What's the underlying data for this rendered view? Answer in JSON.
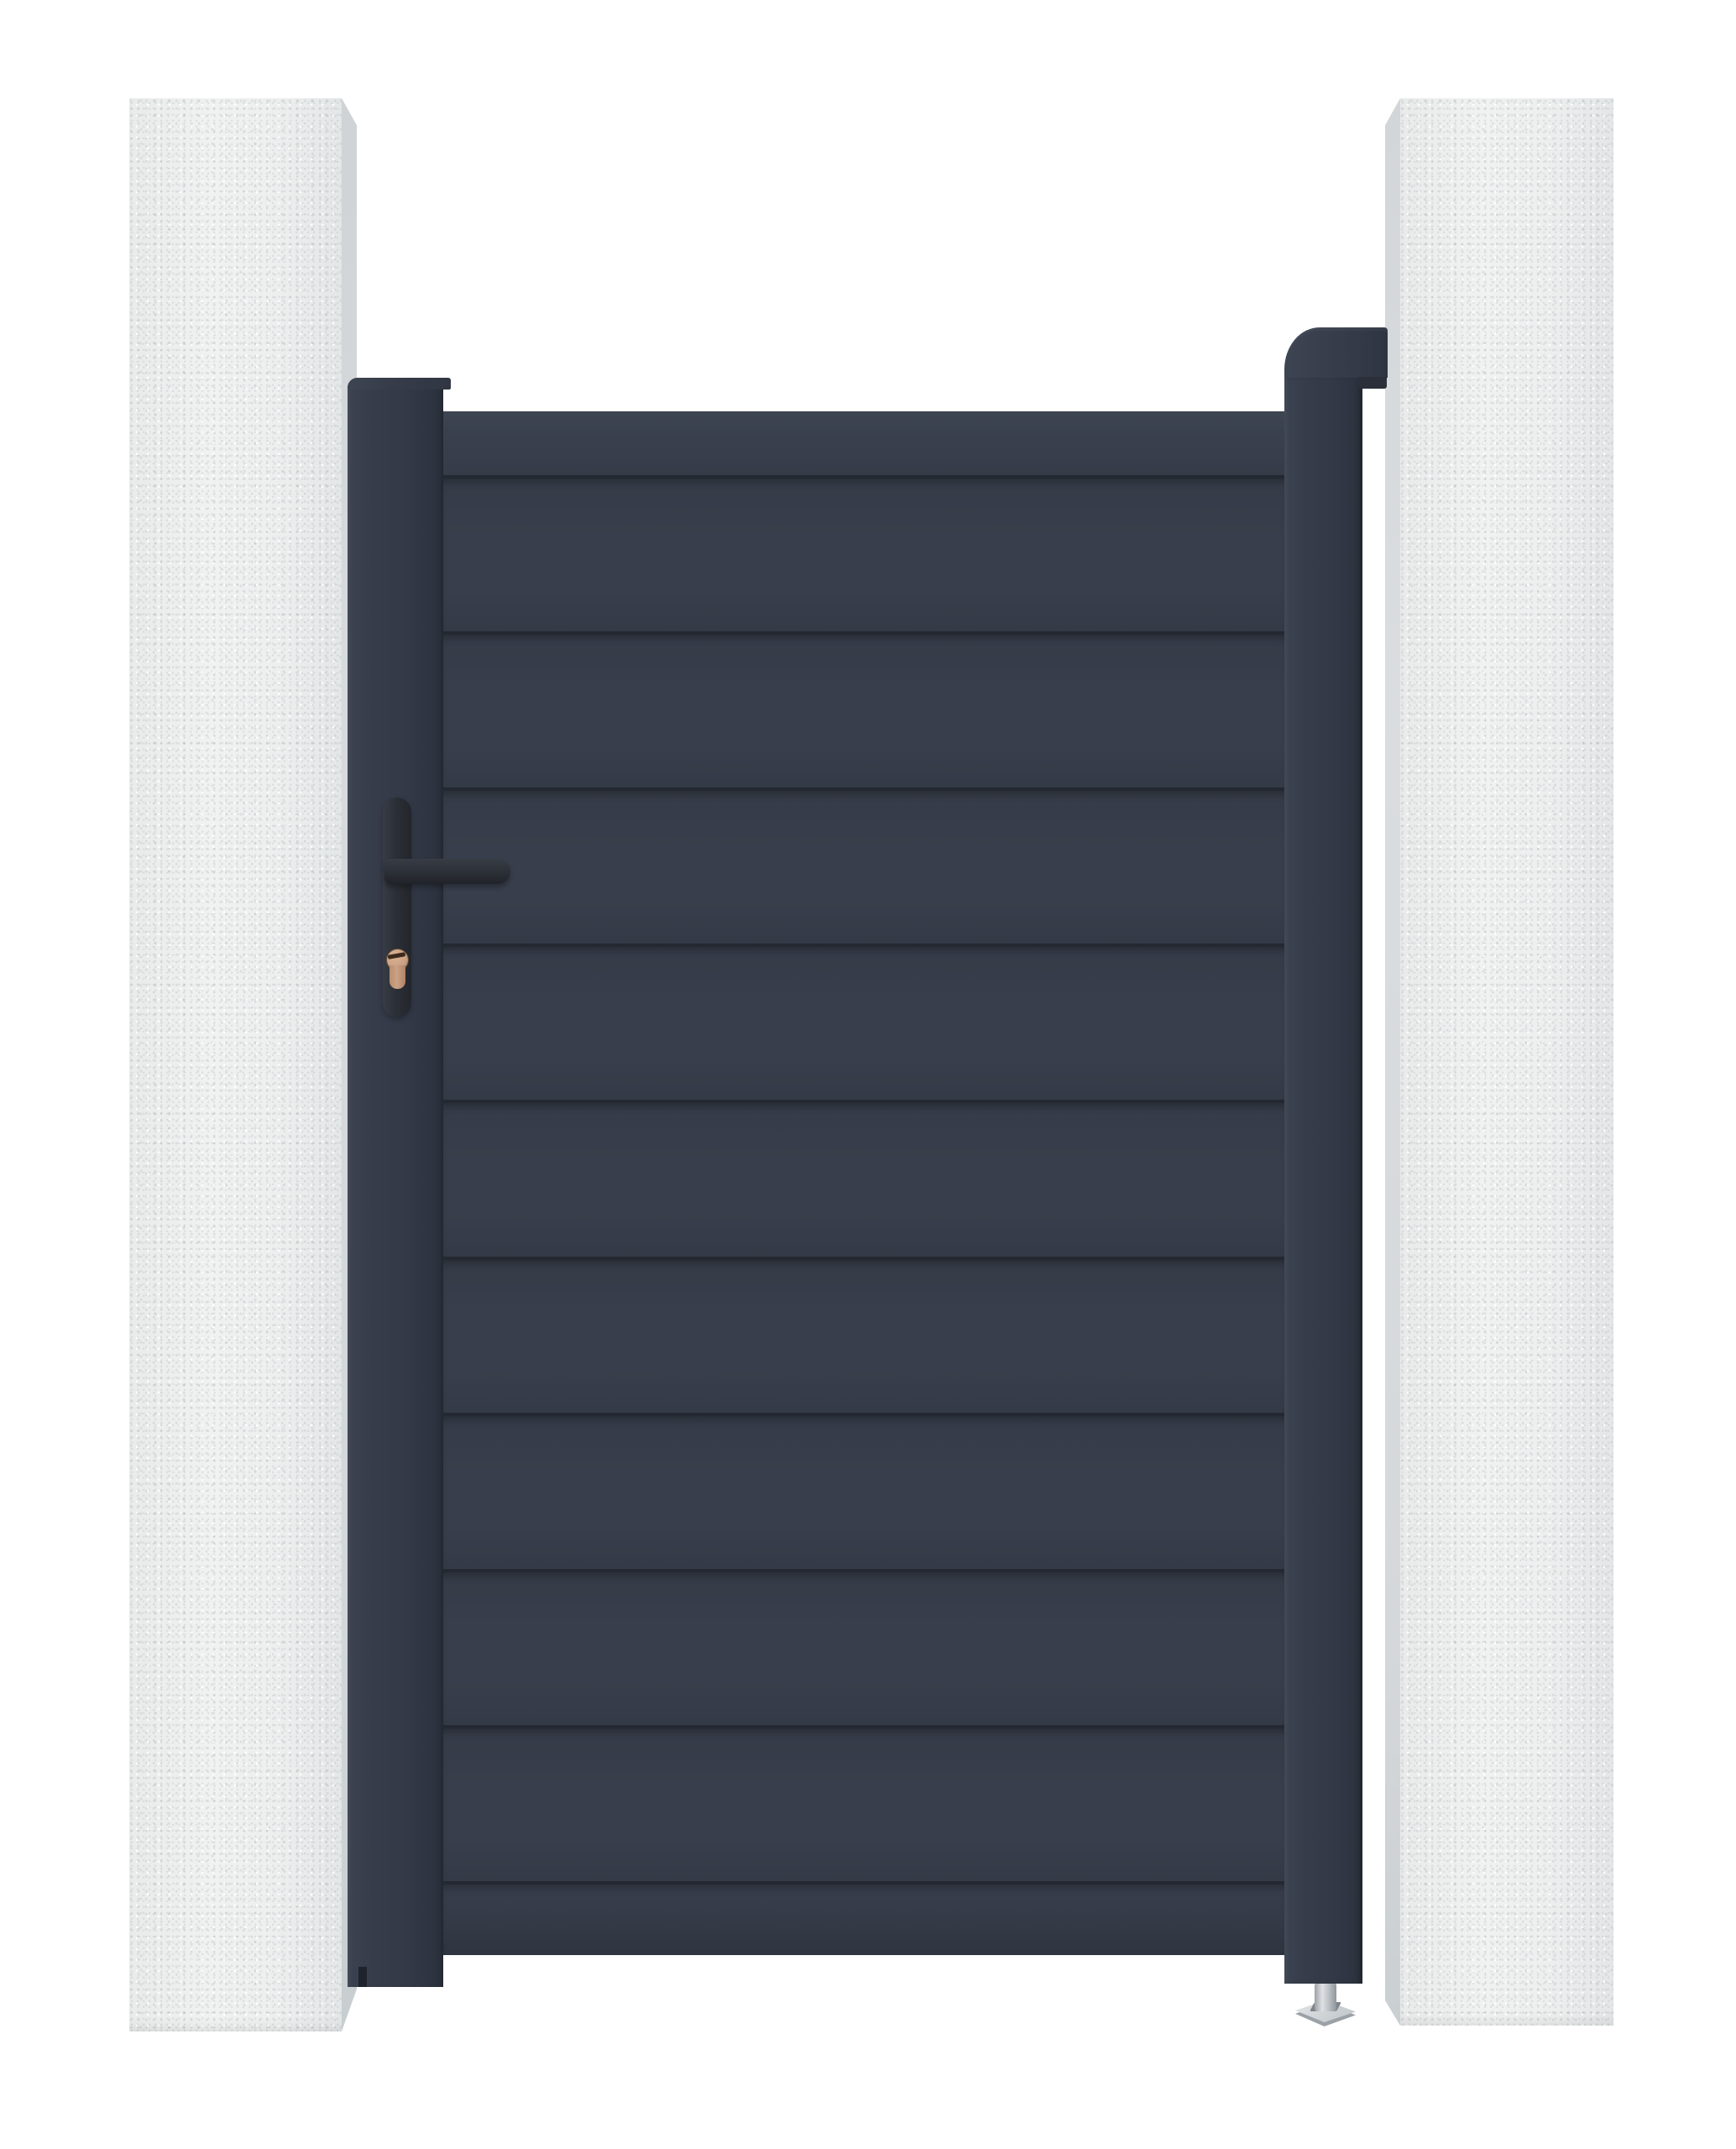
{
  "scene": {
    "type": "product-render",
    "subject": "anthracite aluminium pedestrian garden gate with horizontal slats, hung between two concrete pillars",
    "view": "front, on white background"
  },
  "colors": {
    "background": "#ffffff",
    "gate_face": "#383e4b",
    "gate_face_dark": "#343a46",
    "gate_line": "#232831",
    "post": "#333947",
    "post_dark": "#2b303b",
    "pillar_face": "#eceeee",
    "pillar_side": "#d2d6d8",
    "handle": "#2b2f36",
    "handle_dark": "#202329",
    "cylinder_copper": "#cba285",
    "cylinder_copper_dark": "#a97f62",
    "keyway": "#3c2b1c",
    "foot_metal": "#bcc1c5",
    "foot_metal_dark": "#92989d",
    "foot_plate": "#ced3d6"
  },
  "pillars": {
    "count": 2,
    "material": "light grey rendered concrete",
    "left": {
      "position": "left of gate"
    },
    "right": {
      "position": "right of gate, behind hinge post"
    }
  },
  "gate": {
    "style": "full-privacy horizontal slat infill",
    "slat_count": 9,
    "rails": [
      "top-rail",
      "bottom-rail"
    ],
    "frame": [
      "left-frame-post",
      "hinge-post"
    ],
    "finish": "anthracite grey (RAL 7016 style)"
  },
  "hardware": {
    "handle": {
      "type": "lever handle on long backplate",
      "color_name": "black"
    },
    "lock_cylinder": {
      "type": "euro profile cylinder",
      "color_name": "copper/brass"
    },
    "hinge_post_cap": {
      "shape": "rounded top corner cap hooked toward pillar"
    },
    "adjustable_foot": {
      "type": "threaded leveling foot with square base plate",
      "color_name": "silver"
    }
  }
}
